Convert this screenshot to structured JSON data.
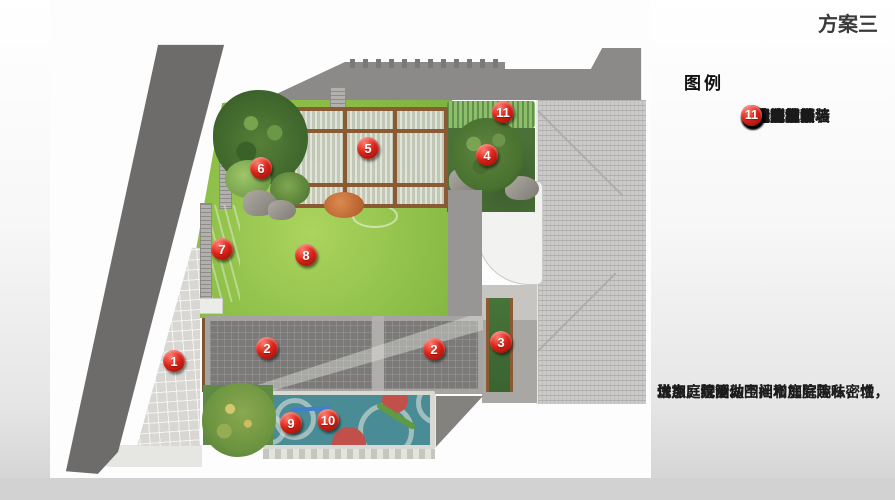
{
  "title": "方案三",
  "legend": {
    "header": "图例",
    "items": [
      {
        "num": "1",
        "label": "出入口铺装"
      },
      {
        "num": "2",
        "label": "庭院铺装"
      },
      {
        "num": "3",
        "label": "特色景墙"
      },
      {
        "num": "4",
        "label": "造型树"
      },
      {
        "num": "5",
        "label": "休闲廊亭"
      },
      {
        "num": "6",
        "label": "置石组景"
      },
      {
        "num": "7",
        "label": "特色水景墙"
      },
      {
        "num": "8",
        "label": "阳光草坪"
      },
      {
        "num": "9",
        "label": "塑胶地面"
      },
      {
        "num": "10",
        "label": "趣味秋千"
      },
      {
        "num": "11",
        "label": "绿篱"
      }
    ]
  },
  "notes": {
    "lines": [
      "优点：绿篱做围挡增加庭院私密性，",
      "增加庭院活动空间和庭院趣味，增",
      "进家庭氛围。"
    ]
  },
  "plan": {
    "markers": [
      {
        "num": "1",
        "x": 174,
        "y": 361,
        "area": "entrance-paving"
      },
      {
        "num": "2",
        "x": 267,
        "y": 348,
        "area": "courtyard-paving-left"
      },
      {
        "num": "2",
        "x": 434,
        "y": 349,
        "area": "courtyard-paving-right"
      },
      {
        "num": "3",
        "x": 501,
        "y": 342,
        "area": "feature-wall"
      },
      {
        "num": "4",
        "x": 487,
        "y": 155,
        "area": "shaped-tree"
      },
      {
        "num": "5",
        "x": 368,
        "y": 148,
        "area": "leisure-pavilion"
      },
      {
        "num": "6",
        "x": 261,
        "y": 168,
        "area": "rock-arrangement"
      },
      {
        "num": "7",
        "x": 222,
        "y": 249,
        "area": "water-feature-wall"
      },
      {
        "num": "8",
        "x": 306,
        "y": 255,
        "area": "sunny-lawn"
      },
      {
        "num": "9",
        "x": 291,
        "y": 423,
        "area": "rubber-ground"
      },
      {
        "num": "10",
        "x": 328,
        "y": 420,
        "area": "fun-swing"
      },
      {
        "num": "11",
        "x": 503,
        "y": 112,
        "area": "hedge"
      }
    ]
  },
  "colors": {
    "accent": "#dd2318",
    "lawn": "#8fc04a",
    "water": "#4d9cb2",
    "play": "#4a8c95",
    "road": "#6e6b6b",
    "roof": "#cbcac8",
    "band": "#8c8a89",
    "court": "#7b7a78",
    "paving": "#d8d7d3",
    "wood": "#8a5a33",
    "bed": "#4a7238",
    "hedge": "#8fbd6b"
  }
}
